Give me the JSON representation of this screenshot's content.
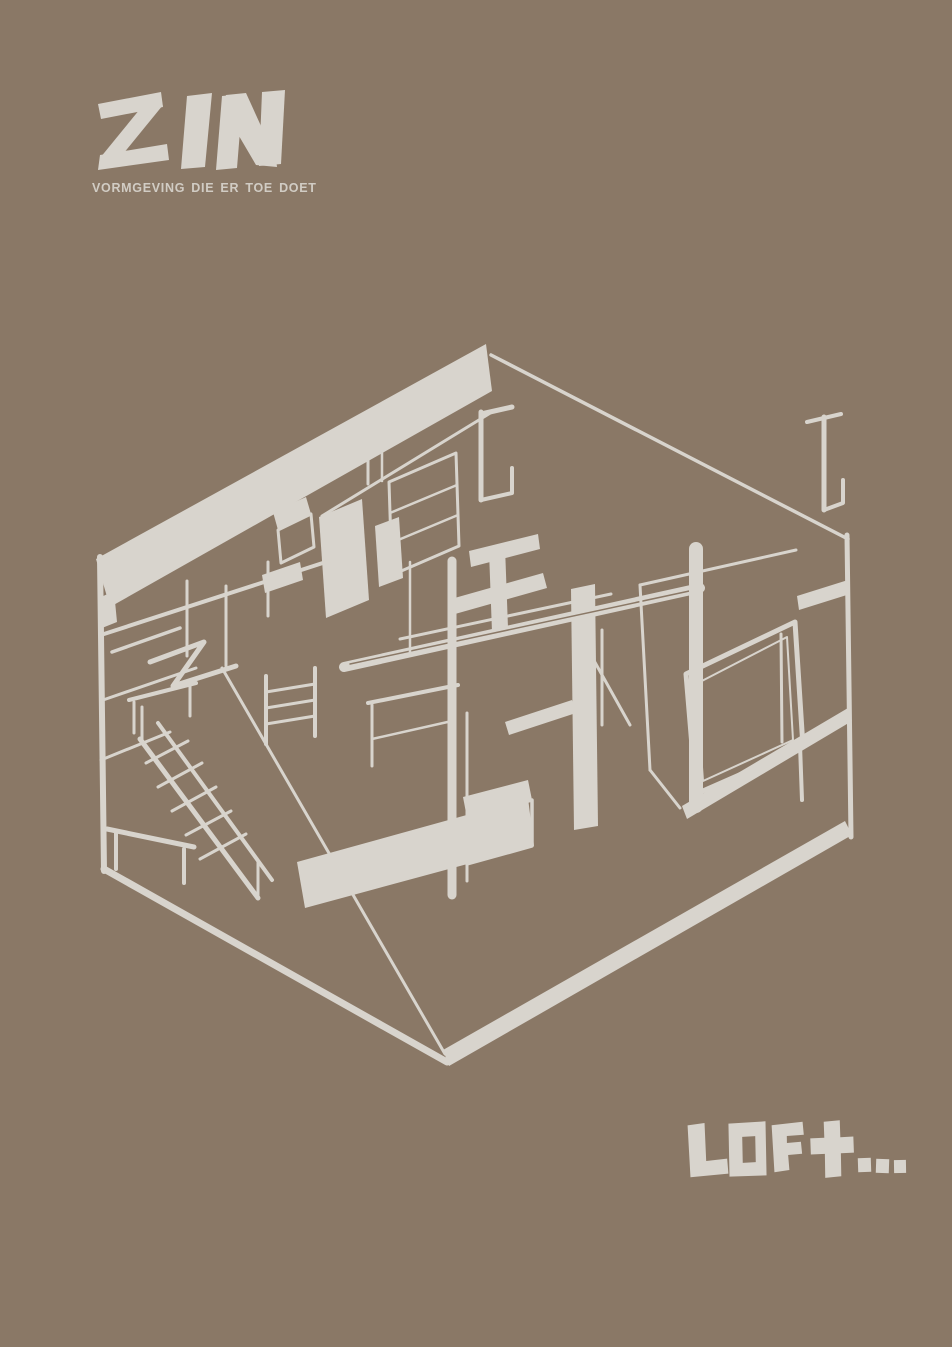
{
  "poster": {
    "background_color": "#8a7866",
    "ink_color": "#d8d4cd",
    "brand": {
      "logo_text": "ZIN",
      "tagline": "VORMGEVING DIE ER TOE DOET"
    },
    "artwork": {
      "alt": "Hand-drawn axonometric line sketch of a loft interior with stairs, columns, beams and a window wall"
    },
    "wordmark": {
      "text": "LOFt..."
    }
  }
}
